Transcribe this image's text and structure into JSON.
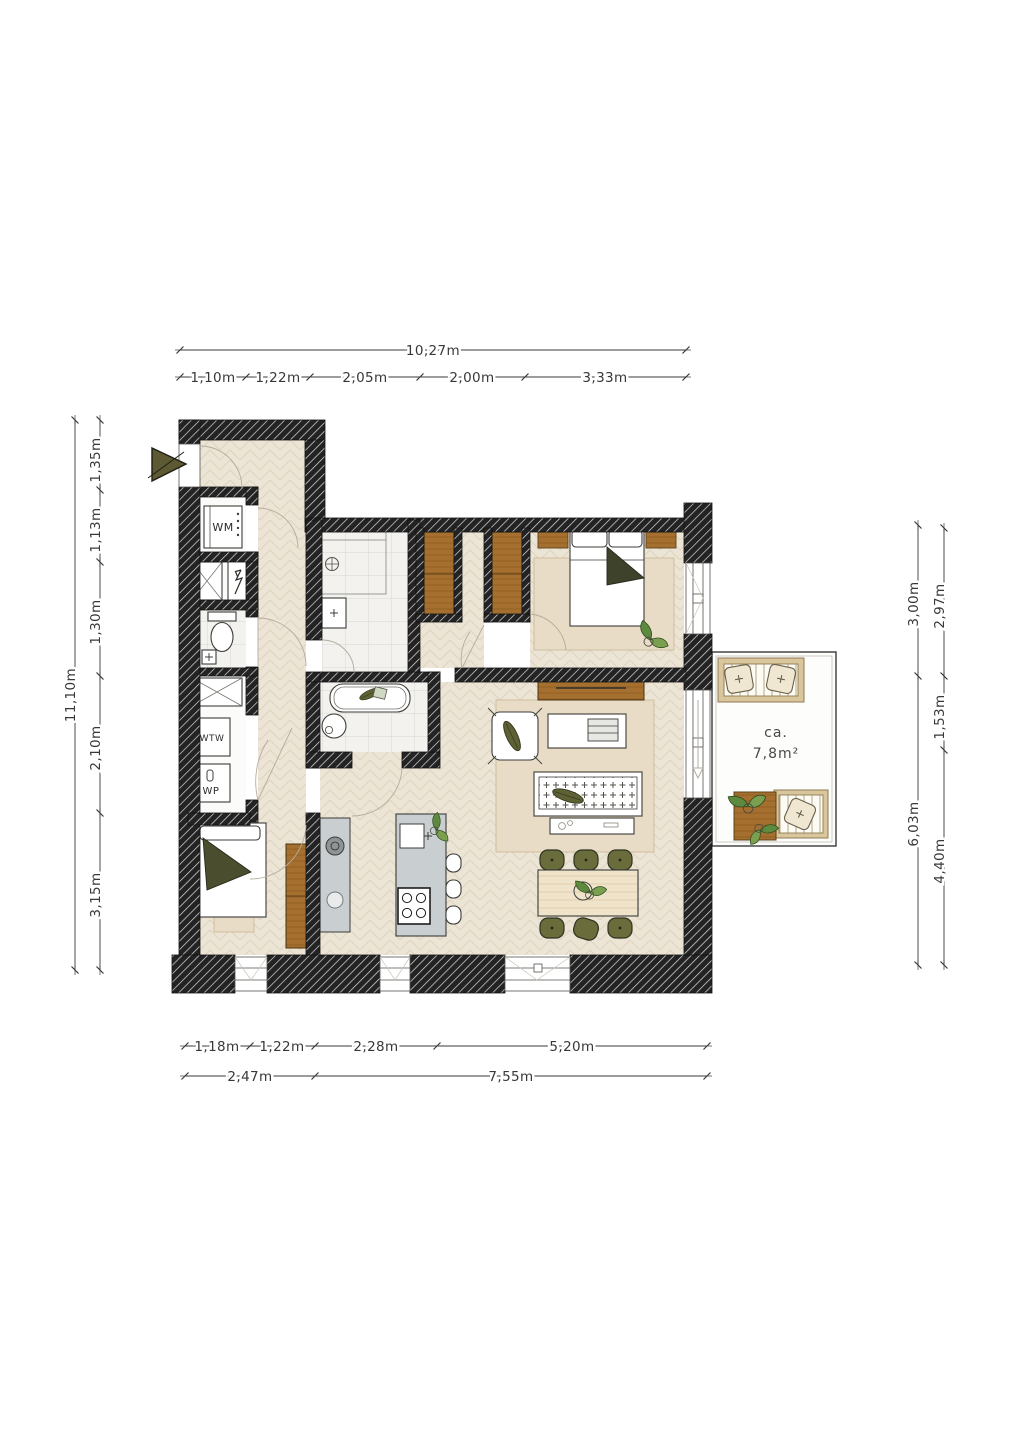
{
  "plan": {
    "type": "apartment-floor-plan",
    "rooms": {
      "wm_label": "WM",
      "wtw_label": "WTW",
      "wp_label": "WP"
    },
    "balcony": {
      "area_prefix": "ca.",
      "area_value": "7,8m²"
    }
  },
  "dimensions": {
    "top": {
      "total": "10,27m",
      "segments": [
        "1,10m",
        "1,22m",
        "2,05m",
        "2,00m",
        "3,33m"
      ]
    },
    "left": {
      "total": "11,10m",
      "segments": [
        "1,35m",
        "1,13m",
        "1,30m",
        "2,10m",
        "3,15m"
      ]
    },
    "right": {
      "outer": [
        "3,00m",
        "6,03m"
      ],
      "inner": [
        "2,97m",
        "1,53m",
        "4,40m"
      ]
    },
    "bottom": {
      "upper": [
        "1,18m",
        "1,22m",
        "2,28m",
        "5,20m"
      ],
      "lower": [
        "2,47m",
        "7,55m"
      ]
    }
  },
  "colors": {
    "wall": "#232323",
    "wall_hatch_line": "#dcdcdc",
    "floor_wood": "#ece4d4",
    "floor_line": "#ded4c0",
    "tile": "#f3f2ef",
    "furniture_wood": "#a5702f",
    "table_wood": "#efe3ca",
    "olive": "#67693a",
    "olive_dark": "#3f422a",
    "rug": "#e9dcc6",
    "counter": "#c9ced0",
    "dimension_text": "#383838"
  }
}
